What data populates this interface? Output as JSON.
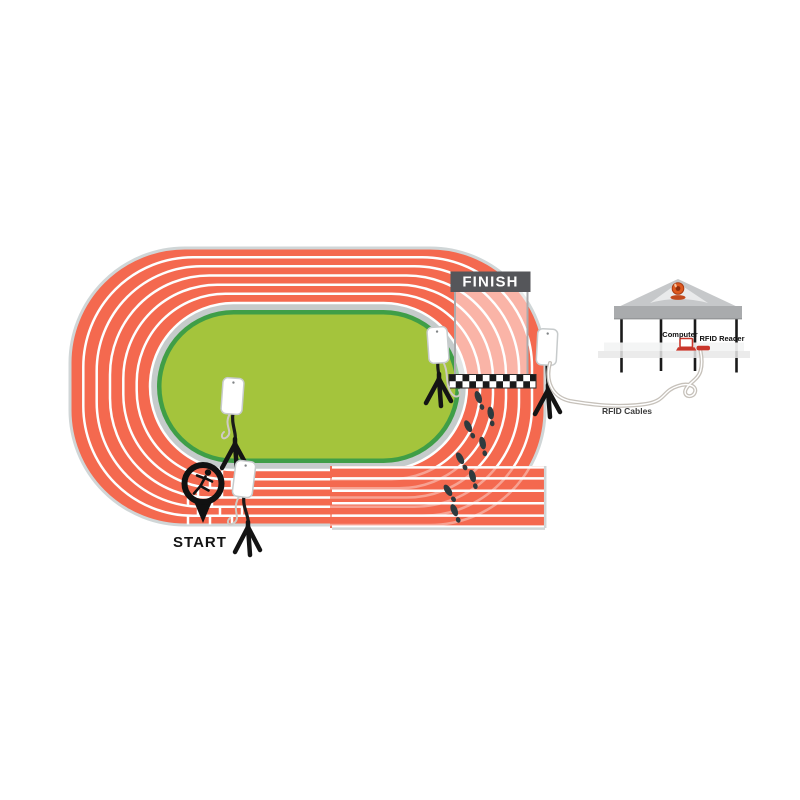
{
  "scene": {
    "description": "RFID race timing system diagram on a six-lane running track",
    "track": {
      "lanes": 6,
      "start_label": "START",
      "finish_label": "FINISH"
    },
    "equipment": {
      "antenna_count": 4,
      "computer_label": "Computer",
      "rfid_reader_label": "RFID Reader",
      "rfid_cables_label": "RFID Cables"
    },
    "icons": [
      "rfid-antenna-icon",
      "tripod-icon",
      "start-pin-icon",
      "runner-icon",
      "footprint-icon",
      "finish-checkered-line",
      "canopy-tent-icon",
      "beacon-light-icon",
      "laptop-icon",
      "rfid-reader-device-icon",
      "cable-icon"
    ],
    "colors": {
      "track": "#F4694F",
      "lane_line": "#FDFFFF",
      "track_border": "#D0D6D7",
      "inner_ring": "#C5CBCB",
      "infield_rim": "#3F9E47",
      "infield": "#A4C43C",
      "finish_banner": "#55565A",
      "checker_dark": "#1A1A1A",
      "footprint": "#2E3A3E",
      "antenna_panel": "#FFFFFF",
      "tripod": "#141414",
      "tent_roof": "#C6C8CA",
      "tent_valance": "#A9ABAD",
      "beacon": "#DF5A1F",
      "device_red": "#C9362B",
      "cable": "#CFCAC4",
      "text": "#141414"
    }
  }
}
